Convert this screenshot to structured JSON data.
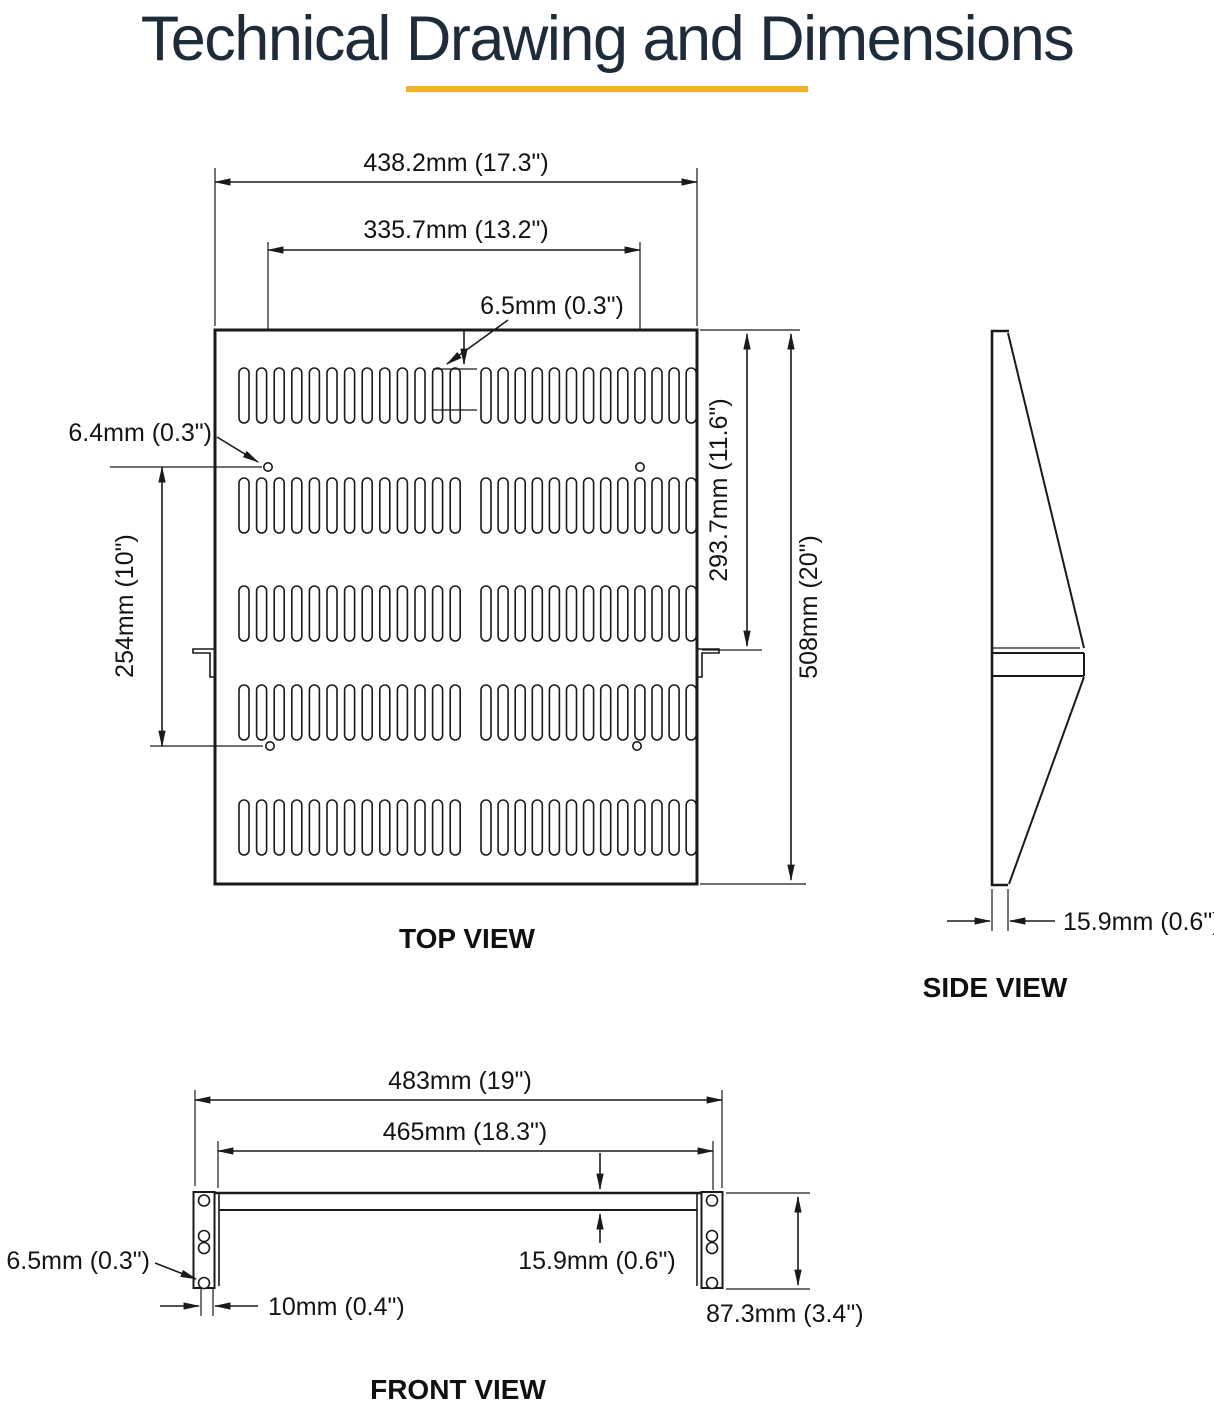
{
  "title": "Technical Drawing and Dimensions",
  "accent_color": "#F4B223",
  "title_color": "#1E2B39",
  "line_color": "#1A1A1A",
  "views": {
    "top": {
      "caption": "TOP VIEW",
      "outer_width": "438.2mm (17.3\")",
      "mount_hole_span": "335.7mm (13.2\")",
      "slot_width": "6.5mm (0.3\")",
      "mount_hole_dia": "6.4mm (0.3\")",
      "mount_hole_pitch": "254mm (10\")",
      "bracket_depth": "293.7mm (11.6\")",
      "depth": "508mm (20\")"
    },
    "side": {
      "caption": "SIDE VIEW",
      "thickness": "15.9mm (0.6\")"
    },
    "front": {
      "caption": "FRONT VIEW",
      "rack_width": "483mm (19\")",
      "inner_width": "465mm (18.3\")",
      "ear_hole_dia": "6.5mm (0.3\")",
      "flange_depth": "10mm (0.4\")",
      "shelf_thickness": "15.9mm (0.6\")",
      "ear_height": "87.3mm (3.4\")"
    }
  }
}
